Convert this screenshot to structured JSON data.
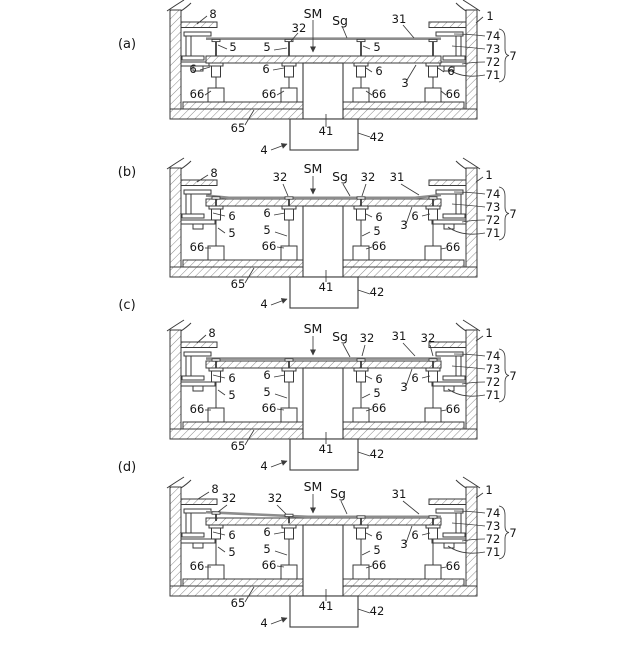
{
  "figure": {
    "type": "patent-cross-section-sequence",
    "panel_tags": [
      "(a)",
      "(b)",
      "(c)",
      "(d)"
    ],
    "labels": {
      "n1": "1",
      "n3": "3",
      "n4": "4",
      "n5": "5",
      "n6": "6",
      "n7": "7",
      "n8": "8",
      "n31": "31",
      "n32": "32",
      "n41": "41",
      "n42": "42",
      "n65": "65",
      "n66": "66",
      "n71": "71",
      "n72": "72",
      "n73": "73",
      "n74": "74",
      "sm": "SM",
      "sg": "Sg"
    },
    "line_color": "#3a3a3a",
    "substrate_color": "#8c8c8c",
    "background": "#ffffff"
  }
}
